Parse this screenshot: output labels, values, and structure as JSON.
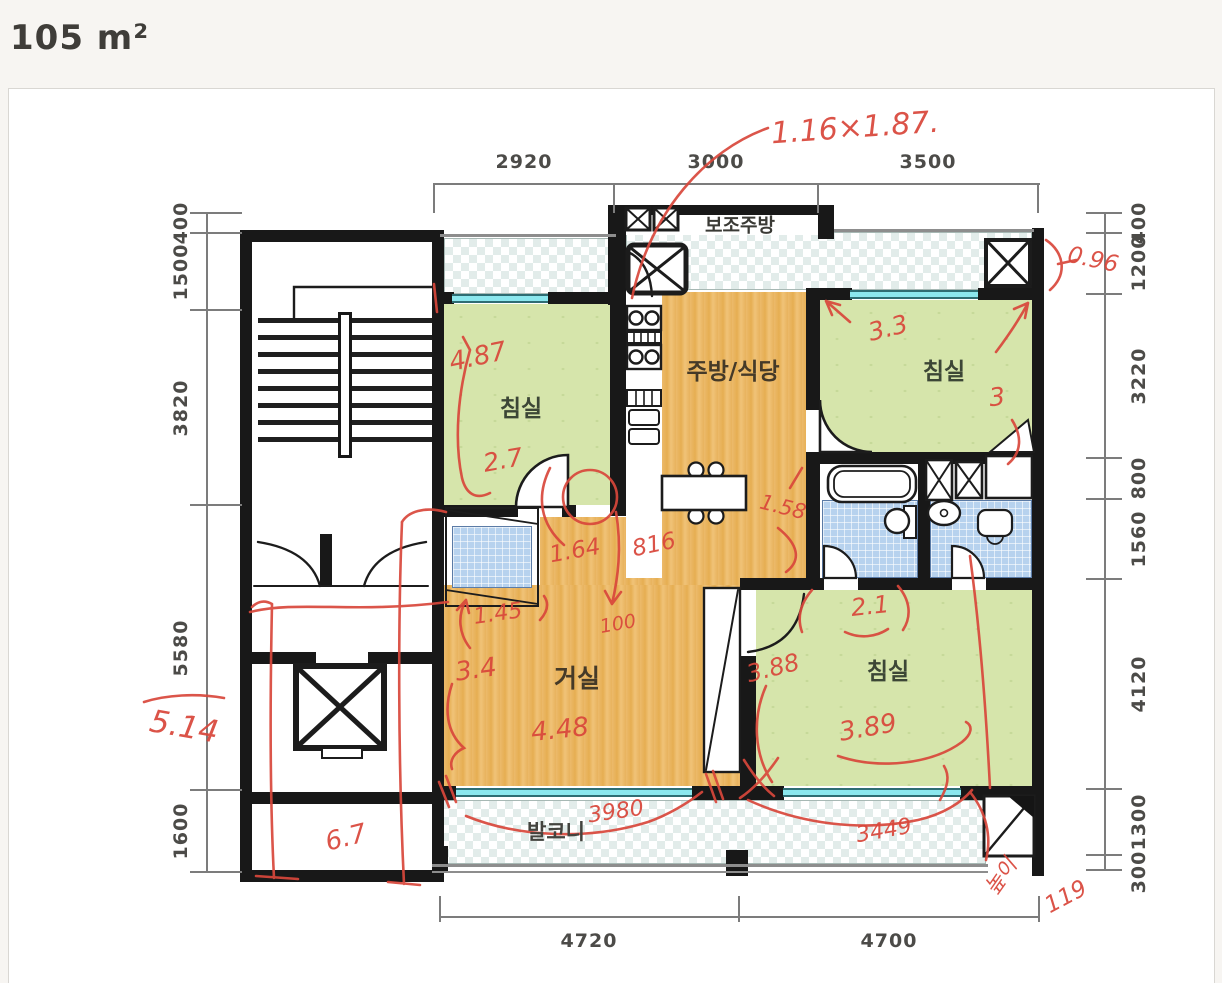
{
  "page": {
    "title": "105 m²"
  },
  "plan": {
    "rooms": {
      "sub_kitchen": "보조주방",
      "bedroom_top_left": "침실",
      "kitchen_dining": "주방/식당",
      "bedroom_top_right": "침실",
      "living_room": "거실",
      "bedroom_bottom_right": "침실",
      "balcony": "발코니"
    },
    "dims": {
      "top": [
        "2920",
        "3000",
        "3500"
      ],
      "left": [
        "400",
        "1500",
        "3820",
        "5580",
        "1600"
      ],
      "right": [
        "400",
        "1200",
        "3220",
        "800",
        "1560",
        "4120",
        "1300",
        "300"
      ],
      "bottom": [
        "4720",
        "4700"
      ]
    },
    "annotations": {
      "window_size": "1.16×1.87.",
      "right_top_width": "0.96",
      "bed1_width": "4.87",
      "bed1_depth": "2.7",
      "bed2_width": "3.3",
      "bed2_depth": "3",
      "kitchen_width": "1.58",
      "hall_a": "1.64",
      "hall_b": "816",
      "entry_width": "1.45",
      "entry_depth": "100",
      "bath_width": "2.1",
      "bed3_depth": "3.88",
      "bed3_width": "3.89",
      "living_depth": "3.4",
      "living_width": "4.48",
      "side_total": "5.14",
      "corridor_width": "6.7",
      "balcony_width_left": "3980",
      "balcony_width_right": "3449",
      "height_label": "높이",
      "height_value": "119"
    }
  },
  "colors": {
    "annotation_red": "#d9473b",
    "wall_black": "#1a1a1a",
    "room_green": "#d6e5ab",
    "floor_wood": "#e9b766",
    "tile_blue": "#b7d2ee",
    "window_cyan": "#8be7ee"
  }
}
